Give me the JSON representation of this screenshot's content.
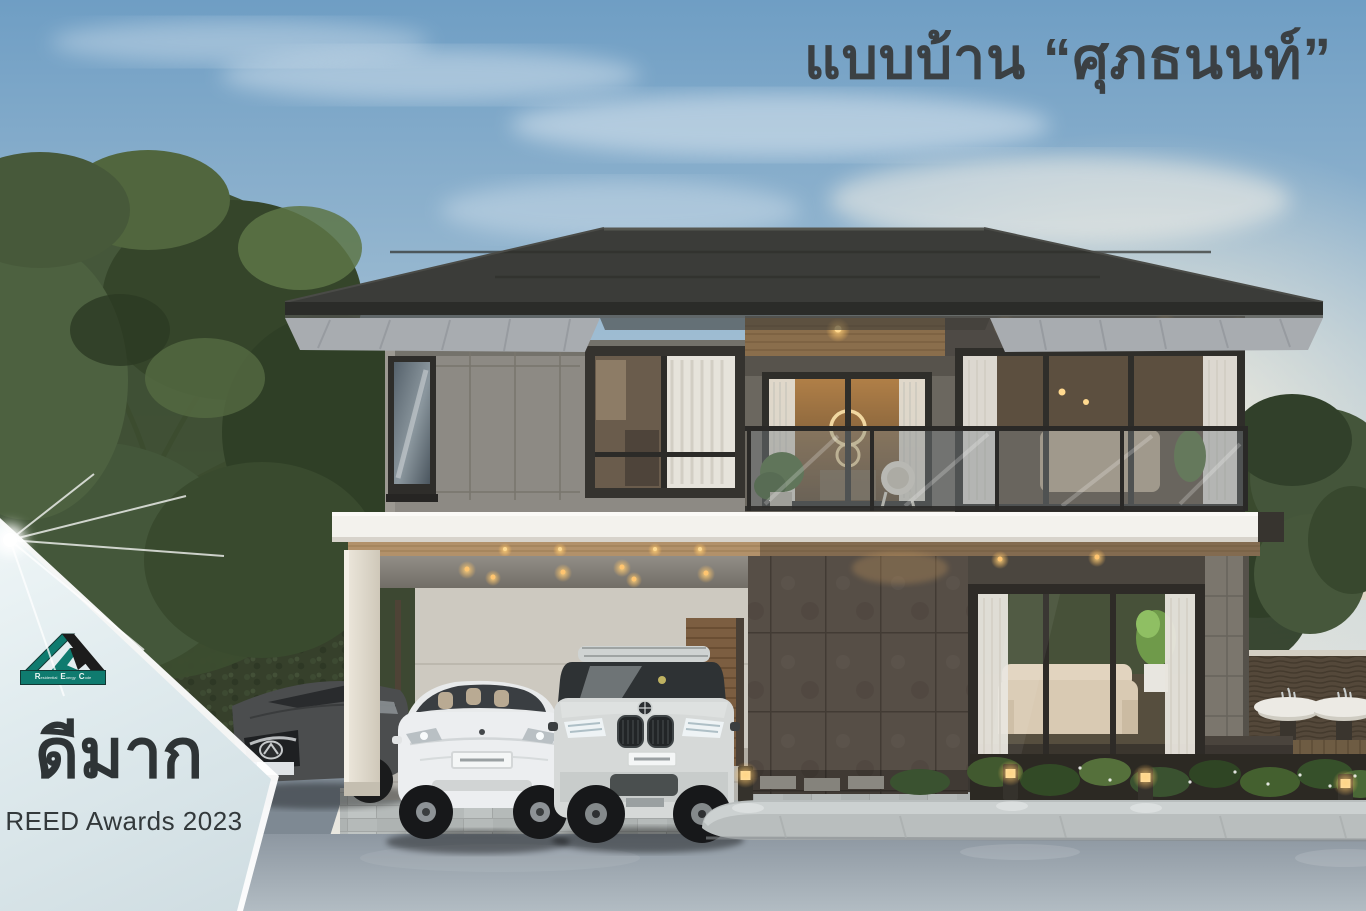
{
  "title": {
    "text": "แบบบ้าน “ศุภธนนท์”"
  },
  "award_badge": {
    "headline": "ดีมาก",
    "subline": "REED Awards 2023",
    "logo_words": {
      "w1": "Residential",
      "w2": "Energy",
      "w3": "Code"
    }
  },
  "palette": {
    "title_text": "#3b4043",
    "badge_background": "#e0ebee",
    "badge_text": "#2e3436",
    "logo_teal": "#0f7b6f",
    "logo_black": "#1c1c1c",
    "roof_charcoal": "#3b3c39",
    "wall_gray": "#8d8a84",
    "slab_white": "#f3f2ed",
    "wood_accent": "#b2916a"
  },
  "alt": "Architectural rendering of a modern two-story house with carport, three cars and garden at dusk"
}
